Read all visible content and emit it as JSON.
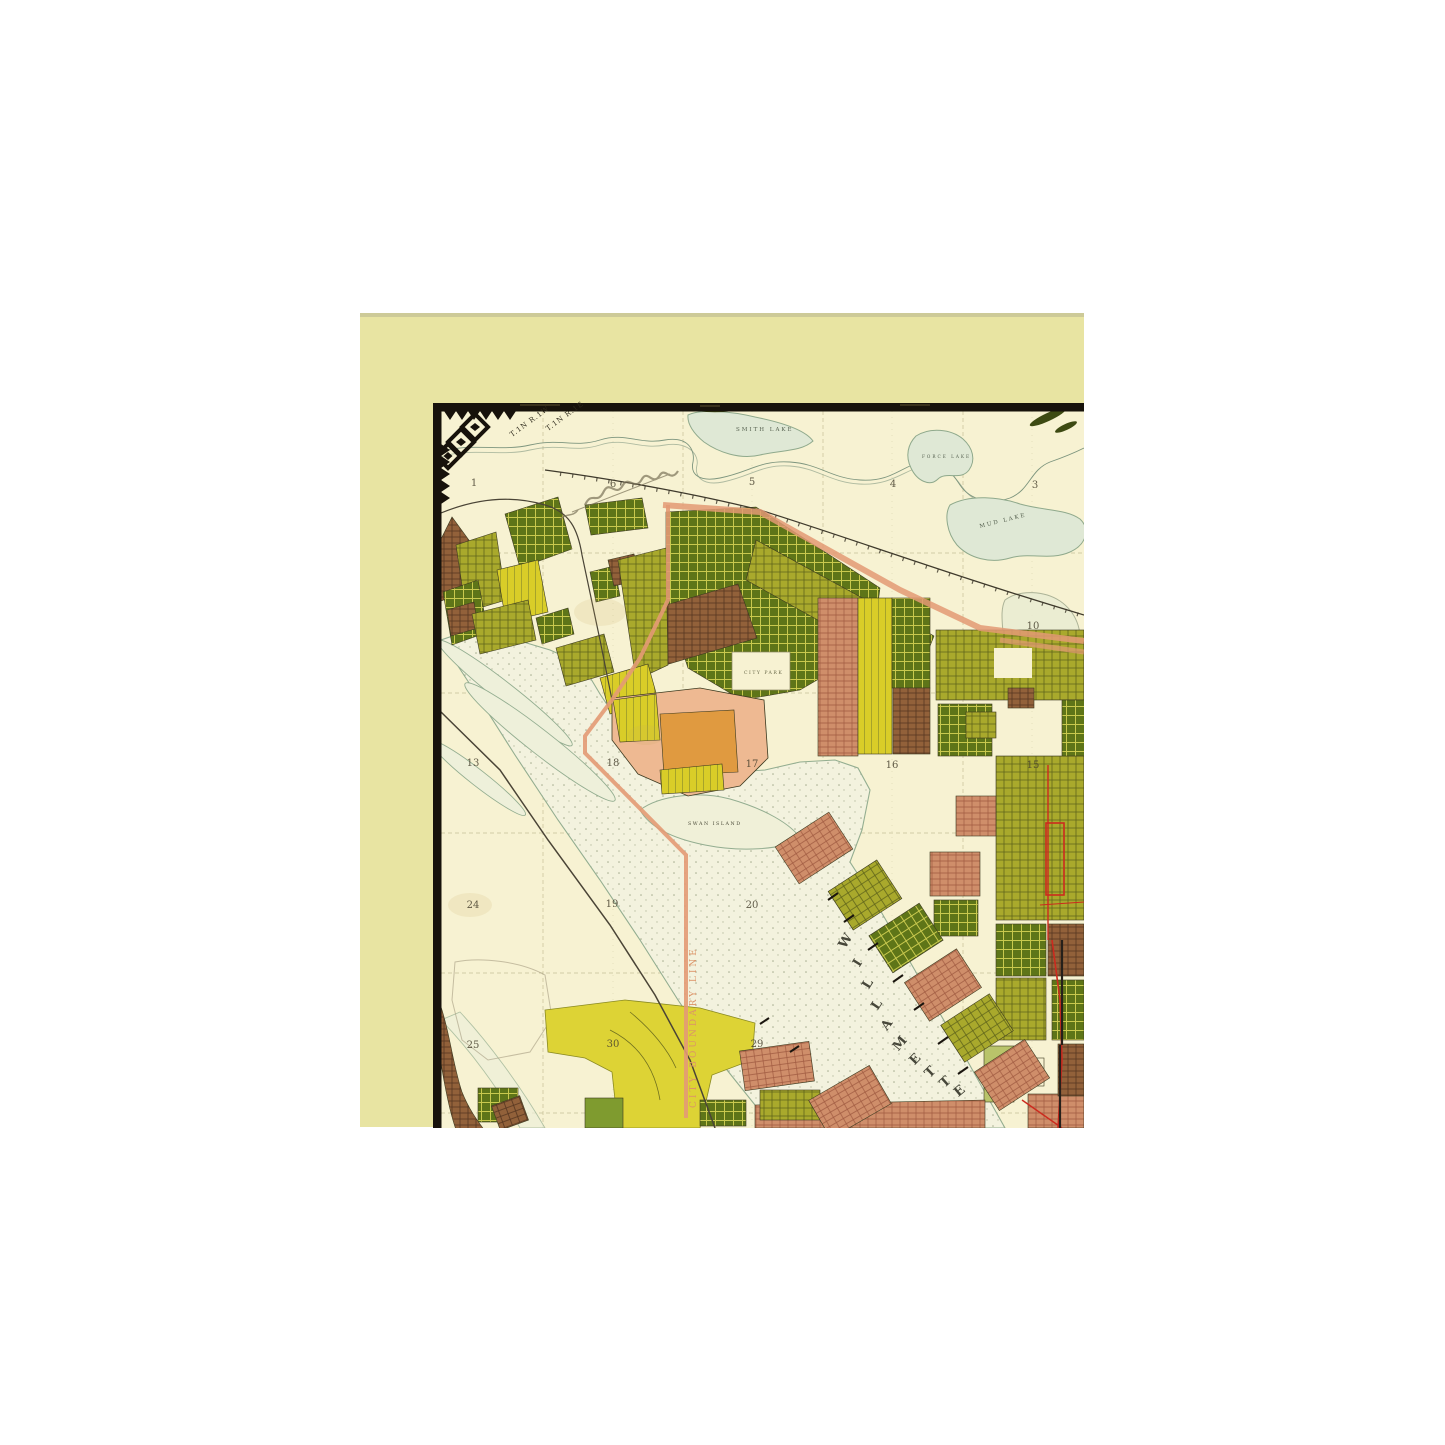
{
  "map": {
    "description": "Antique plat map, north Portland Oregon peninsula with Willamette River",
    "labels": {
      "township_left": "T.1N R.1W",
      "township_right": "T.1N R.1E",
      "smith_lake": "SMITH LAKE",
      "force_lake": "FORCE LAKE",
      "mud_lake": "MUD LAKE",
      "city_park": "CITY PARK",
      "swan_island": "SWAN ISLAND",
      "city_boundary": "CITY BOUNDARY LINE"
    },
    "river_name": "WILLAMETTE",
    "river_letters": [
      {
        "t": "W",
        "x": 849,
        "y": 943,
        "r": -58
      },
      {
        "t": "I",
        "x": 861,
        "y": 965,
        "r": -58
      },
      {
        "t": "L",
        "x": 871,
        "y": 986,
        "r": -58
      },
      {
        "t": "L",
        "x": 880,
        "y": 1007,
        "r": -56
      },
      {
        "t": "A",
        "x": 890,
        "y": 1027,
        "r": -54
      },
      {
        "t": "M",
        "x": 903,
        "y": 1046,
        "r": -50
      },
      {
        "t": "E",
        "x": 918,
        "y": 1062,
        "r": -46
      },
      {
        "t": "T",
        "x": 933,
        "y": 1075,
        "r": -44
      },
      {
        "t": "T",
        "x": 948,
        "y": 1085,
        "r": -42
      },
      {
        "t": "E",
        "x": 962,
        "y": 1094,
        "r": -40
      }
    ],
    "section_numbers": [
      {
        "t": "1",
        "x": 474,
        "y": 486
      },
      {
        "t": "6",
        "x": 613,
        "y": 487
      },
      {
        "t": "5",
        "x": 752,
        "y": 485
      },
      {
        "t": "4",
        "x": 893,
        "y": 487
      },
      {
        "t": "3",
        "x": 1035,
        "y": 488
      },
      {
        "t": "10",
        "x": 1033,
        "y": 629
      },
      {
        "t": "13",
        "x": 473,
        "y": 766
      },
      {
        "t": "18",
        "x": 613,
        "y": 766
      },
      {
        "t": "17",
        "x": 752,
        "y": 767
      },
      {
        "t": "16",
        "x": 892,
        "y": 768
      },
      {
        "t": "15",
        "x": 1033,
        "y": 768
      },
      {
        "t": "24",
        "x": 473,
        "y": 908
      },
      {
        "t": "19",
        "x": 612,
        "y": 907
      },
      {
        "t": "20",
        "x": 752,
        "y": 908
      },
      {
        "t": "25",
        "x": 473,
        "y": 1048
      },
      {
        "t": "30",
        "x": 613,
        "y": 1047
      },
      {
        "t": "29",
        "x": 757,
        "y": 1047
      }
    ],
    "colors": {
      "paper": "#e8e4a2",
      "map_ground": "#f7f2d2",
      "river": "#f3f2de",
      "plat_dark_green": "#5e7518",
      "plat_olive": "#a9a92c",
      "plat_yellow": "#d9cd28",
      "plat_brown": "#92613a",
      "plat_pink": "#cf8e6a",
      "plat_peach": "#eeb992",
      "plat_orange": "#e09a40",
      "boundary_salmon": "#e39a74",
      "street_red": "#cc2a1e",
      "border_ink": "#17120b"
    }
  }
}
